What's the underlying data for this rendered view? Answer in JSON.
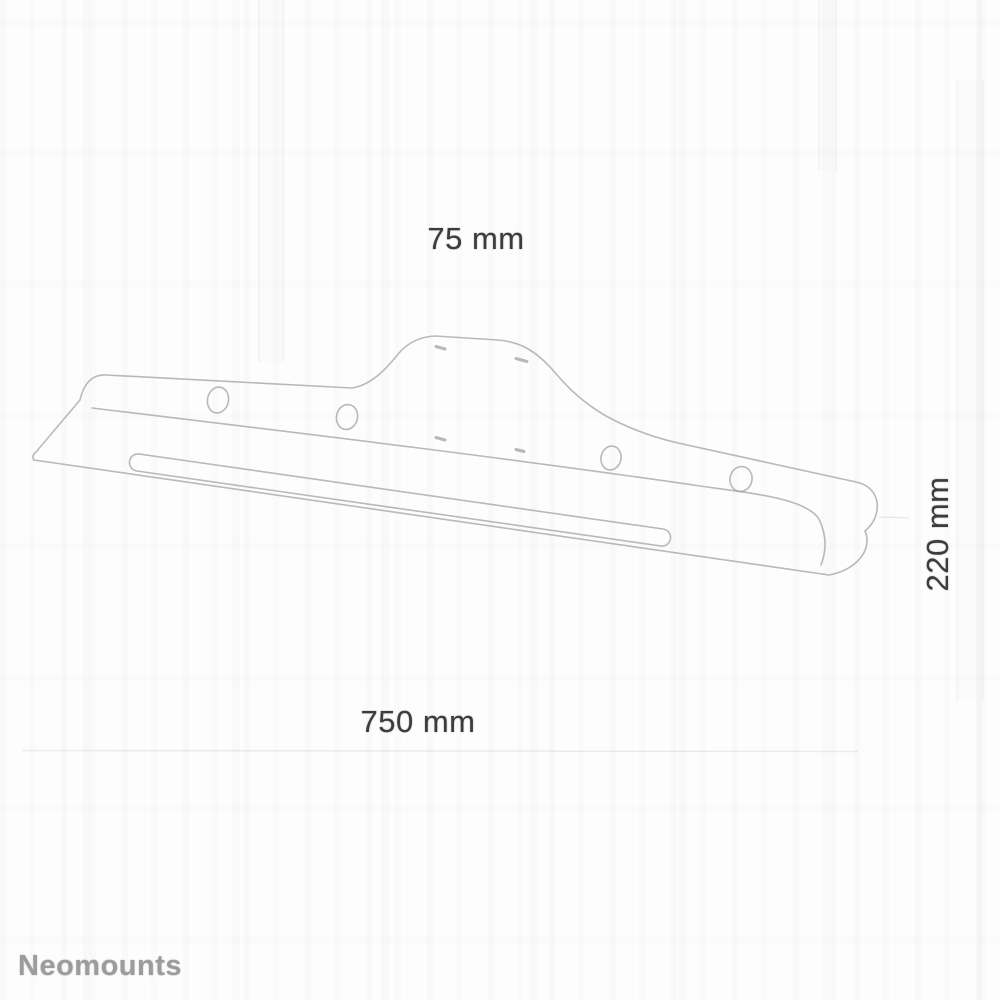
{
  "page": {
    "background": "#fcfcfc"
  },
  "brand": {
    "name": "Neomounts",
    "color": "#9c9c9c"
  },
  "diagram": {
    "type": "technical-dimension-drawing",
    "line_color": "#b3b3b3",
    "label_color": "#3c3c3c",
    "dimensions": {
      "vesa": {
        "label": "75 mm",
        "value": 75,
        "unit": "mm"
      },
      "width": {
        "label": "750 mm",
        "value": 750,
        "unit": "mm"
      },
      "depth": {
        "label": "220 mm",
        "value": 220,
        "unit": "mm"
      }
    },
    "features": {
      "round_holes": 4,
      "small_screw_slots": 4,
      "long_slot": 1
    }
  }
}
